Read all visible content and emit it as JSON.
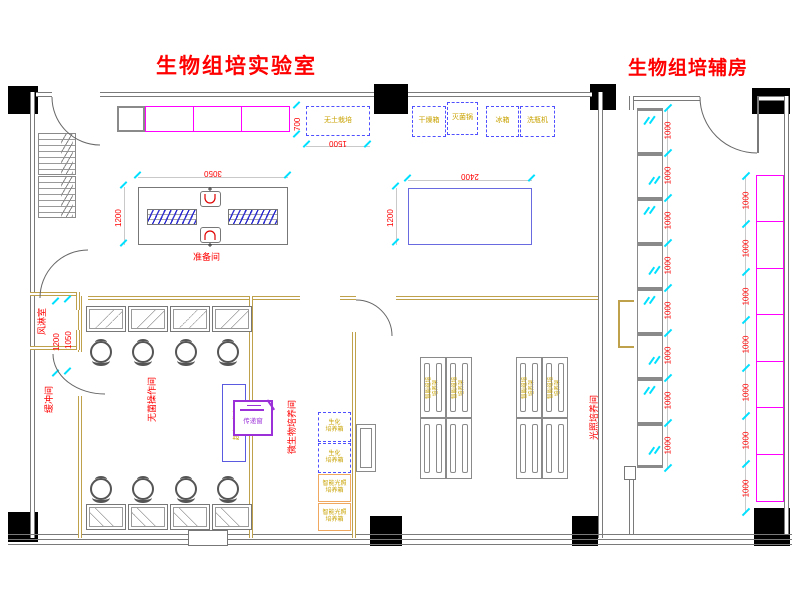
{
  "titles": {
    "lab": "生物组培实验室",
    "aux": "生物组培辅房"
  },
  "rooms": {
    "prep": "准备间",
    "air_shower": "风淋室",
    "buffer": "缓冲间",
    "sterile_op": "无菌操作间",
    "microbe": "微生物培养间",
    "light": "光照培养间"
  },
  "top_equipment": {
    "soilless": "无土栽培",
    "units": [
      "干燥箱",
      "灭菌锅",
      "冰箱",
      "洗瓶机"
    ]
  },
  "sterile_room": {
    "clean_bench": "超净工作台",
    "pass_window": "传递窗"
  },
  "microbe_room": {
    "incubators": [
      {
        "text": "生化\n培养箱",
        "style": "dashed"
      },
      {
        "text": "生化\n培养箱",
        "style": "dashed"
      },
      {
        "text": "智能光照\n培养箱",
        "style": "orange"
      },
      {
        "text": "智能光照\n培养箱",
        "style": "orange"
      }
    ]
  },
  "light_room": {
    "rack_label": "智能组培\n培养架"
  },
  "dimensions": {
    "prep_table_w": "3050",
    "prep_table_h": "1200",
    "work_table_w": "2400",
    "work_table_h": "1200",
    "soilless_w": "1500",
    "soilless_h": "700",
    "air_shower_a": "1200",
    "air_shower_b": "1050",
    "aux_window_dims": [
      "1000",
      "1000",
      "1000",
      "1000",
      "1000",
      "1000",
      "1000",
      "1000"
    ],
    "aux_bench_dims": [
      "1000",
      "1000",
      "1000",
      "1000",
      "1000",
      "1000",
      "1000"
    ]
  },
  "colors": {
    "label_red": "#FE0000",
    "magenta": "#FF00FF",
    "dash_blue": "#5050FF",
    "cyan_tick": "#00E0FF",
    "equip_yellow": "#C8A200",
    "purple": "#9B30D9",
    "tan_wall": "#BFA14B",
    "gray_wall": "#7A7A7A"
  }
}
